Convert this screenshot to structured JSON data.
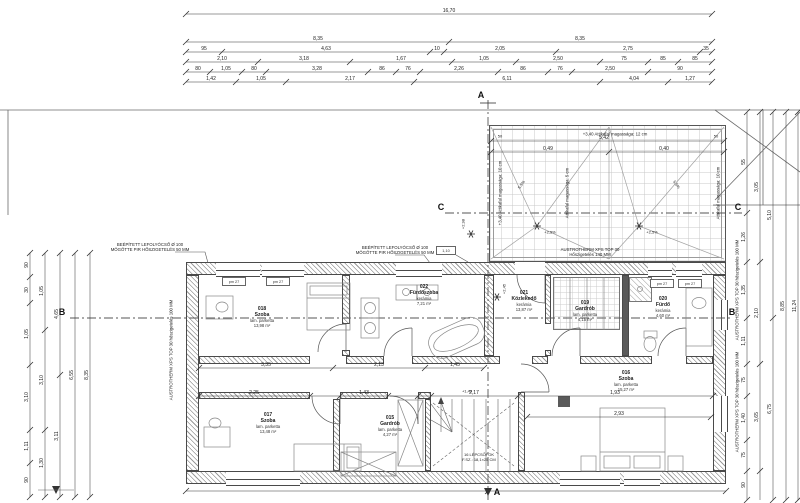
{
  "drawing": {
    "section_markers": {
      "a": "A",
      "b": "B",
      "c": "C"
    },
    "levels": {
      "l298": "+2,98",
      "l245": "+2,45",
      "l149": "+1,49"
    },
    "notes": {
      "drain1a": "BEÉPÍTETT LEFOLYÓCSŐ Ø 100",
      "drain1b": "MÖGÖTTE PIR HŐSZIGETELÉS 50 MM",
      "xps_side": "AUSTROTHERM XPS TOP 30 hőszigetelés 100 MM",
      "xps_roof_a": "AUSTROTHERM XPS TOP 30",
      "xps_roof_b": "Hőszigetelés 140 MM",
      "attika12": "+3,40 Attikafal magassága: 12 cm",
      "attika10_left": "+3,40 Attikafal magassága: 10 cm",
      "attika10_right": "Attikafal magassága: 10 cm",
      "attika5": "Attikafal magassága: 5 cm",
      "slope": "5,5%",
      "slope_drain": "+2,5%",
      "parapet": "pm 27",
      "detail_mark": "1,10"
    },
    "stairs": {
      "line1": "16 LÉPCSŐFOK",
      "line2": "F.SZ.: 18,1×25 CM"
    }
  },
  "rooms": [
    {
      "id": "018",
      "name": "Szoba",
      "finish": "lam. parketta",
      "area": "13,98 m²",
      "x": 262,
      "y": 318
    },
    {
      "id": "022",
      "name": "Fürdőszoba",
      "finish": "kerámia",
      "area": "7,21 m²",
      "x": 424,
      "y": 296
    },
    {
      "id": "021",
      "name": "Közlekedő",
      "finish": "kerámia",
      "area": "13,87 m²",
      "x": 524,
      "y": 302
    },
    {
      "id": "019",
      "name": "Gardrób",
      "finish": "lam. parketta",
      "area": "4,15 m²",
      "x": 585,
      "y": 312
    },
    {
      "id": "020",
      "name": "Fürdő",
      "finish": "kerámia",
      "area": "4,60 m²",
      "x": 663,
      "y": 308
    },
    {
      "id": "017",
      "name": "Szoba",
      "finish": "lam. parketta",
      "area": "13,48 m²",
      "x": 268,
      "y": 424
    },
    {
      "id": "015",
      "name": "Gardrób",
      "finish": "lam. parketta",
      "area": "4,27 m²",
      "x": 390,
      "y": 427
    },
    {
      "id": "016",
      "name": "Szoba",
      "finish": "lam. parketta",
      "area": "15,27 m²",
      "x": 626,
      "y": 382
    }
  ],
  "roof_dims": {
    "total": "5,42",
    "left": "0,49",
    "right": "0,40",
    "edge": "50"
  },
  "dims": {
    "h_chains": [
      {
        "y": 14,
        "x1": 186,
        "x2": 712,
        "ticks": [
          186,
          712
        ],
        "labels": [
          {
            "x": 449,
            "v": "16,70"
          }
        ]
      },
      {
        "y": 42,
        "x1": 186,
        "x2": 712,
        "ticks": [
          186,
          449,
          712
        ],
        "labels": [
          {
            "x": 318,
            "v": "8,35"
          },
          {
            "x": 580,
            "v": "8,35"
          }
        ]
      },
      {
        "y": 52,
        "x1": 186,
        "x2": 712,
        "ticks": [
          186,
          222,
          430,
          444,
          556,
          700,
          712
        ],
        "labels": [
          {
            "x": 204,
            "v": "95"
          },
          {
            "x": 326,
            "v": "4,63"
          },
          {
            "x": 437,
            "v": "10"
          },
          {
            "x": 500,
            "v": "2,05"
          },
          {
            "x": 628,
            "v": "2,75"
          },
          {
            "x": 706,
            "v": "35"
          }
        ]
      },
      {
        "y": 62,
        "x1": 186,
        "x2": 712,
        "ticks": [
          186,
          258,
          350,
          452,
          516,
          600,
          648,
          678,
          712
        ],
        "labels": [
          {
            "x": 222,
            "v": "2,10"
          },
          {
            "x": 304,
            "v": "3,18"
          },
          {
            "x": 401,
            "v": "1,67"
          },
          {
            "x": 484,
            "v": "1,05"
          },
          {
            "x": 558,
            "v": "2,50"
          },
          {
            "x": 624,
            "v": "75"
          },
          {
            "x": 663,
            "v": "85"
          },
          {
            "x": 695,
            "v": "85"
          }
        ]
      },
      {
        "y": 72,
        "x1": 186,
        "x2": 712,
        "ticks": [
          186,
          210,
          242,
          266,
          368,
          396,
          420,
          498,
          548,
          572,
          648,
          712
        ],
        "labels": [
          {
            "x": 198,
            "v": "80"
          },
          {
            "x": 226,
            "v": "1,05"
          },
          {
            "x": 254,
            "v": "80"
          },
          {
            "x": 317,
            "v": "3,28"
          },
          {
            "x": 382,
            "v": "86"
          },
          {
            "x": 408,
            "v": "76"
          },
          {
            "x": 459,
            "v": "2,26"
          },
          {
            "x": 523,
            "v": "86"
          },
          {
            "x": 560,
            "v": "76"
          },
          {
            "x": 610,
            "v": "2,50"
          },
          {
            "x": 680,
            "v": "90"
          }
        ]
      },
      {
        "y": 82,
        "x1": 186,
        "x2": 712,
        "ticks": [
          186,
          236,
          286,
          414,
          600,
          668,
          712
        ],
        "labels": [
          {
            "x": 211,
            "v": "1,42"
          },
          {
            "x": 261,
            "v": "1,05"
          },
          {
            "x": 350,
            "v": "2,17"
          },
          {
            "x": 507,
            "v": "6,11"
          },
          {
            "x": 634,
            "v": "4,04"
          },
          {
            "x": 690,
            "v": "1,27"
          }
        ]
      },
      {
        "y": 141,
        "x1": 491,
        "x2": 724,
        "ticks": [
          491,
          724
        ],
        "labels": [
          {
            "x": 604,
            "v": "5,42"
          }
        ]
      },
      {
        "y": 152,
        "x1": 491,
        "x2": 724,
        "ticks": [
          491,
          609,
          724
        ],
        "labels": [
          {
            "x": 548,
            "v": "0,49"
          },
          {
            "x": 664,
            "v": "0,40"
          }
        ]
      },
      {
        "y": 368,
        "x1": 199,
        "x2": 484,
        "ticks": [
          199,
          333,
          425,
          484
        ],
        "labels": [
          {
            "x": 266,
            "v": "3,35"
          },
          {
            "x": 379,
            "v": "2,13"
          },
          {
            "x": 455,
            "v": "1,45"
          }
        ]
      },
      {
        "y": 396,
        "x1": 199,
        "x2": 713,
        "ticks": [
          199,
          310,
          340,
          388,
          418,
          431,
          518,
          713
        ],
        "labels": [
          {
            "x": 254,
            "v": "2,25"
          },
          {
            "x": 364,
            "v": "1,43"
          },
          {
            "x": 474,
            "v": "2,17"
          },
          {
            "x": 615,
            "v": "1,93"
          }
        ]
      },
      {
        "y": 417,
        "x1": 527,
        "x2": 711,
        "ticks": [
          527,
          711
        ],
        "labels": [
          {
            "x": 619,
            "v": "2,93"
          }
        ]
      },
      {
        "y": 491,
        "x1": 186,
        "x2": 726,
        "ticks": [
          186,
          488,
          726
        ],
        "labels": []
      }
    ],
    "v_chains": [
      {
        "x": 30,
        "y1": 253,
        "y2": 497,
        "ticks": [
          253,
          277,
          303,
          365,
          430,
          463,
          497
        ],
        "labels": [
          {
            "y": 265,
            "v": "90"
          },
          {
            "y": 290,
            "v": "30"
          },
          {
            "y": 334,
            "v": "1,05"
          },
          {
            "y": 397,
            "v": "3,10"
          },
          {
            "y": 446,
            "v": "1,11"
          },
          {
            "y": 480,
            "v": "90"
          }
        ]
      },
      {
        "x": 45,
        "y1": 253,
        "y2": 497,
        "ticks": [
          253,
          330,
          430,
          497
        ],
        "labels": [
          {
            "y": 291,
            "v": "1,05"
          },
          {
            "y": 380,
            "v": "3,10"
          },
          {
            "y": 463,
            "v": "1,30"
          }
        ]
      },
      {
        "x": 60,
        "y1": 253,
        "y2": 497,
        "ticks": [
          253,
          375,
          497
        ],
        "labels": [
          {
            "y": 314,
            "v": "4,65"
          },
          {
            "y": 436,
            "v": "3,11"
          }
        ]
      },
      {
        "x": 75,
        "y1": 253,
        "y2": 497,
        "ticks": [
          253,
          497
        ],
        "labels": [
          {
            "y": 375,
            "v": "6,55"
          }
        ]
      },
      {
        "x": 90,
        "y1": 253,
        "y2": 497,
        "ticks": [
          253,
          497
        ],
        "labels": [
          {
            "y": 375,
            "v": "8,35"
          }
        ]
      },
      {
        "x": 747,
        "y1": 112,
        "y2": 500,
        "ticks": [
          112,
          213,
          262,
          318,
          364,
          396,
          440,
          471,
          500
        ],
        "labels": [
          {
            "y": 162,
            "v": "55"
          },
          {
            "y": 237,
            "v": "1,26"
          },
          {
            "y": 290,
            "v": "1,35"
          },
          {
            "y": 341,
            "v": "1,11"
          },
          {
            "y": 380,
            "v": "75"
          },
          {
            "y": 418,
            "v": "1,40"
          },
          {
            "y": 455,
            "v": "75"
          },
          {
            "y": 485,
            "v": "90"
          }
        ]
      },
      {
        "x": 760,
        "y1": 112,
        "y2": 500,
        "ticks": [
          112,
          262,
          364,
          471
        ],
        "labels": [
          {
            "y": 187,
            "v": "3,05"
          },
          {
            "y": 313,
            "v": "2,10"
          },
          {
            "y": 417,
            "v": "3,65"
          }
        ]
      },
      {
        "x": 773,
        "y1": 112,
        "y2": 500,
        "ticks": [
          112,
          318,
          500
        ],
        "labels": [
          {
            "y": 215,
            "v": "5,10"
          },
          {
            "y": 409,
            "v": "6,75"
          }
        ]
      },
      {
        "x": 786,
        "y1": 112,
        "y2": 500,
        "ticks": [
          112,
          500
        ],
        "labels": [
          {
            "y": 306,
            "v": "8,85"
          }
        ]
      },
      {
        "x": 798,
        "y1": 112,
        "y2": 500,
        "ticks": [
          112,
          500
        ],
        "labels": [
          {
            "y": 306,
            "v": "11,24"
          }
        ]
      }
    ]
  },
  "colors": {
    "line": "#3a3a3a",
    "hatch": "#9a9a9a",
    "grid": "#c9c9c9",
    "dash": "#555555"
  }
}
